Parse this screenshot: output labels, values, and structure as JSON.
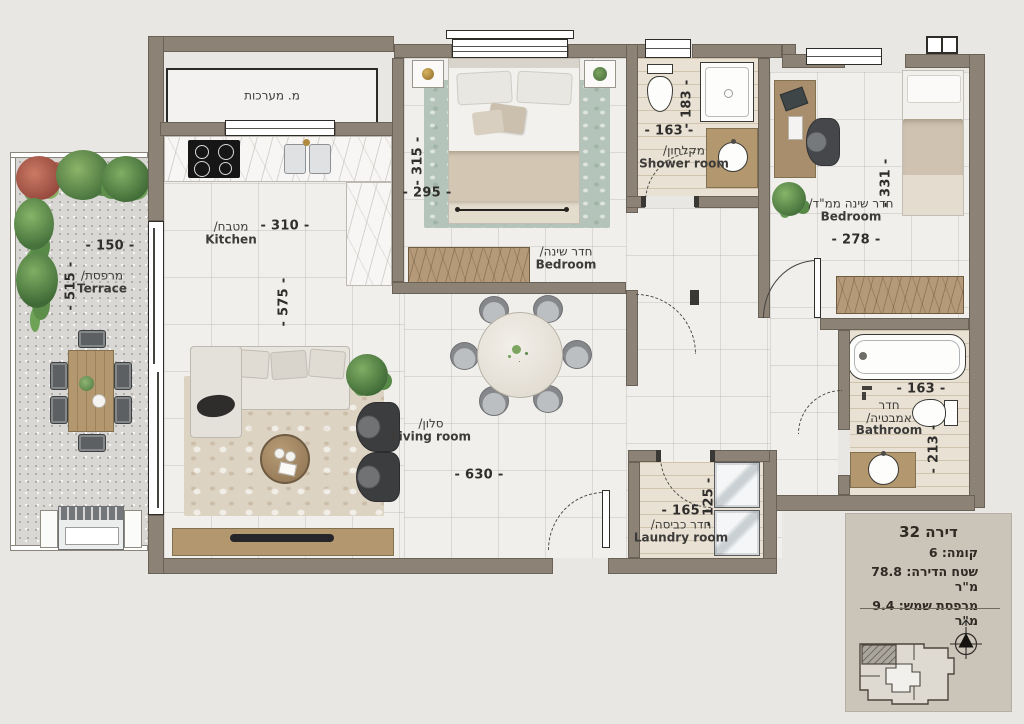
{
  "colors": {
    "background": "#e9e7e4",
    "wall": "#8d8276",
    "wood": "#b2976f",
    "info_box_bg": "#cbc4b8"
  },
  "rooms": {
    "systems": {
      "label_he": "מ. מערכות"
    },
    "kitchen": {
      "label_he": "מטבח/",
      "label_en": "Kitchen",
      "dim_width": "- 310 -",
      "dim_height": "- 575 -"
    },
    "bedroom_middle": {
      "label_he": "חדר שינה/",
      "label_en": "Bedroom",
      "dim_height": "- 315 -",
      "dim_width": "- 295 -"
    },
    "shower_room": {
      "label_he": "מקלחון/",
      "label_en": "Shower room",
      "dim_width": "- 163 -",
      "dim_height": "- 183 -"
    },
    "bedroom_mamad": {
      "label_he": "חדר שינה ממ\"ד/",
      "label_en": "Bedroom",
      "dim_height": "- 331 -",
      "dim_width": "- 278 -"
    },
    "terrace": {
      "label_he": "מרפסת/",
      "label_en": "Terrace",
      "dim_width": "- 150 -",
      "dim_height": "- 515 -"
    },
    "living_room": {
      "label_he": "סלון/",
      "label_en": "Living room",
      "dim_width": "- 630 -"
    },
    "laundry_room": {
      "label_he": "חדר כביסה/",
      "label_en": "Laundry room",
      "dim_width": "- 165 -",
      "dim_height": "- 125 -"
    },
    "bathroom": {
      "label_he_1": "חדר",
      "label_he_2": "אמבטיה/",
      "label_en": "Bathroom",
      "dim_width": "- 163 -",
      "dim_height": "- 213 -"
    }
  },
  "info_box": {
    "title": "דירה 32",
    "floor_line": "קומה: 6",
    "area_line": "שטח הדירה: 78.8 מ\"ר",
    "balcony_line": "מרפסת שמש: 9.4 מ\"ר"
  }
}
